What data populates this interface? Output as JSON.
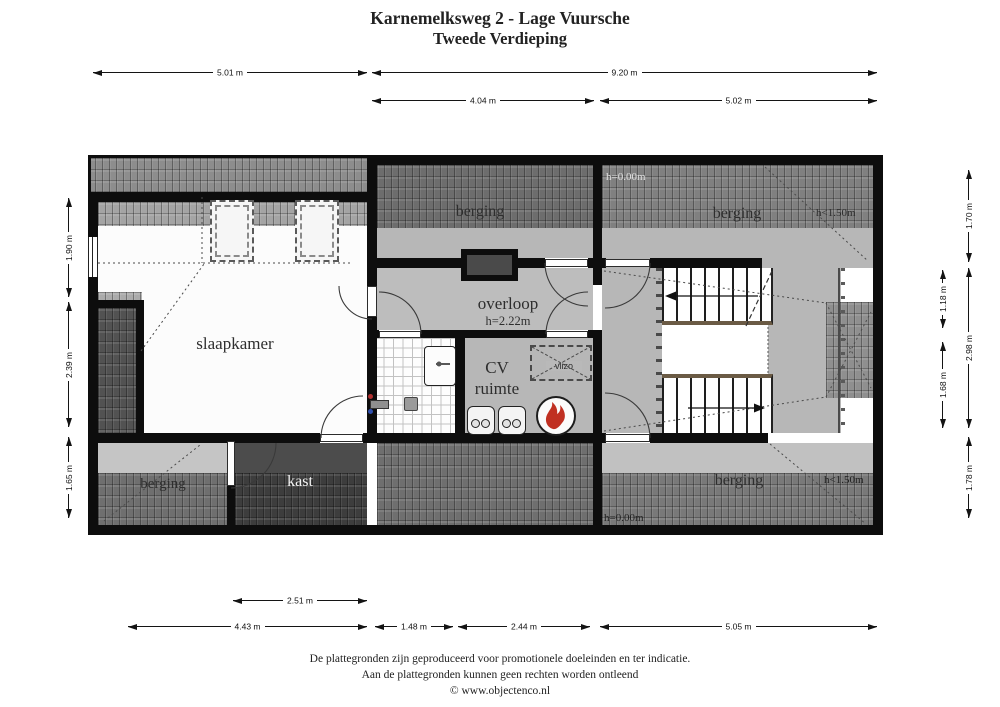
{
  "title": {
    "line1": "Karnemelksweg 2 - Lage Vuursche",
    "line2": "Tweede Verdieping"
  },
  "plan": {
    "rooms": {
      "slaapkamer": {
        "label": "slaapkamer"
      },
      "overloop": {
        "label": "overloop",
        "height": "h=2.22m"
      },
      "cv_ruimte": {
        "label_line1": "CV",
        "label_line2": "ruimte",
        "vlizo_label": "vlizo"
      },
      "berging_top_middle": {
        "label": "berging"
      },
      "berging_top_right": {
        "label": "berging",
        "h_eaves": "h=0.00m",
        "h_limit": "h<1.50m"
      },
      "berging_bottom_left": {
        "label": "berging"
      },
      "berging_bottom_right": {
        "label": "berging",
        "h_eaves": "h=0.00m",
        "h_limit": "h<1.50m"
      },
      "kast": {
        "label": "kast"
      }
    },
    "colors": {
      "wall": "#0d0d0d",
      "floor_gray": "#b7b7b7",
      "flame_red": "#c03022",
      "hot_tap": "#b03030",
      "cold_tap": "#2f4fae"
    }
  },
  "dimensions": {
    "top": {
      "d501": "5.01 m",
      "d920": "9.20 m",
      "d404": "4.04 m",
      "d502": "5.02 m"
    },
    "bottom": {
      "d251": "2.51 m",
      "d443": "4.43 m",
      "d148": "1.48 m",
      "d244": "2.44 m",
      "d505": "5.05 m"
    },
    "left": {
      "d190": "1.90 m",
      "d239": "2.39 m",
      "d165": "1.65 m"
    },
    "right": {
      "d118": "1.18 m",
      "d168": "1.68 m",
      "d170": "1.70 m",
      "d298": "2.98 m",
      "d178": "1.78 m"
    }
  },
  "footer": {
    "line1": "De plattegronden zijn geproduceerd voor promotionele doeleinden en ter indicatie.",
    "line2": "Aan de plattegronden kunnen geen rechten worden ontleend",
    "line3": "© www.objectenco.nl"
  }
}
